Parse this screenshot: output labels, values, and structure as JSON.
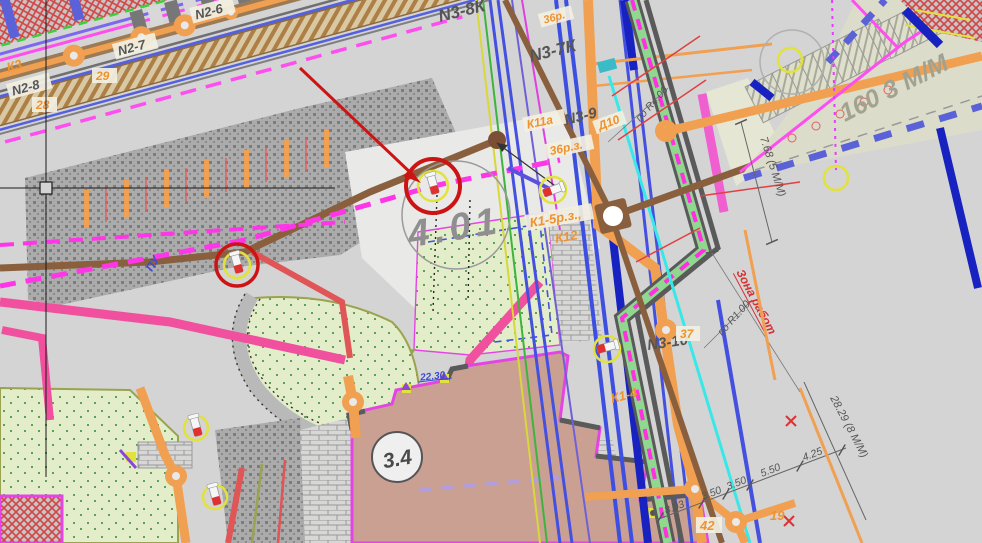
{
  "app": {
    "type": "cad-site-plan-viewport"
  },
  "colors": {
    "background": "#d4d4d4",
    "markup_red": "#cc1414",
    "magenta": "#ff4df0",
    "pink_road": "#f0509e",
    "orange_pipe": "#f0a050",
    "brown_main": "#8a5f3e",
    "cyan_line": "#38e8e8",
    "navy_line": "#1822c0",
    "blue_line": "#4450e0",
    "duct_green": "#90d890",
    "lawn_green": "#e2edc8",
    "building_fill": "#c9a092",
    "yellow_marker": "#e2e23c"
  },
  "labels": {
    "n2_6": "N2-6",
    "n2_7": "N2-7",
    "n2_8": "N2-8",
    "k3": "К3",
    "n29": "29",
    "n28": "28",
    "n3_8k": "N3-8К",
    "n3_7k": "N3-7К",
    "n3_9": "N3-9",
    "n3_10": "N3-10",
    "r36_top": "36р.",
    "k11a": "К11а",
    "d10": "Д10",
    "r36": "36р.з.",
    "k1_5": "К1-5р.з.,",
    "k12": "К12",
    "k1_4": "К1-4",
    "n37": "37",
    "n42": "42",
    "n19": "19",
    "big401": "4.01",
    "big34": "3.4",
    "parking160": "160 3 М/М",
    "pu": "ПУ",
    "e2230": "22.30",
    "dim768": "7.68 (5 М/М)",
    "dim2829": "28.29 (8 М/М)",
    "dim803": "8.03",
    "dim350a": "3.50",
    "dim350b": "3.50",
    "dim550": "5.50",
    "dim425": "4.25",
    "po_r400": "по R4.00",
    "po_r100": "по R1.00",
    "zona": "Зона работ"
  }
}
